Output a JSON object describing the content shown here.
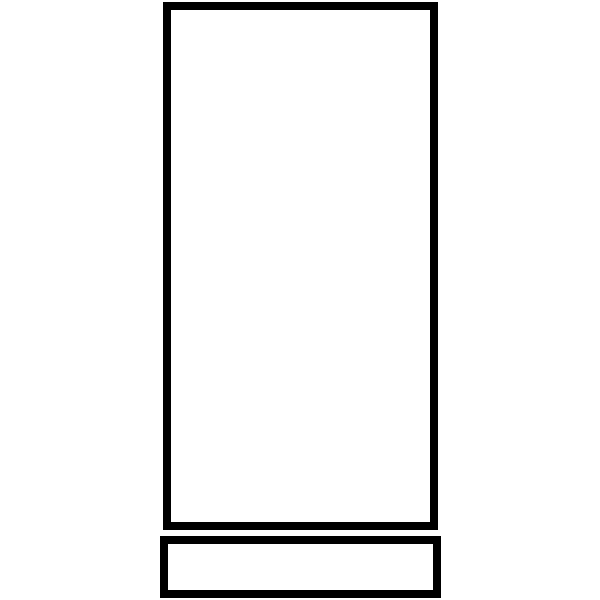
{
  "canvas": {
    "width": 600,
    "height": 600,
    "background_color": "#ffffff"
  },
  "colors": {
    "stroke": "#000000",
    "fill": "#ffffff"
  },
  "shapes": [
    {
      "id": "tall-rectangle-outline",
      "type": "rectangle",
      "x": 163,
      "y": 2,
      "width": 275,
      "height": 528,
      "stroke_color": "#000000",
      "stroke_width": 8,
      "fill_color": "#ffffff"
    },
    {
      "id": "wide-rectangle-outline",
      "type": "rectangle",
      "x": 160,
      "y": 536,
      "width": 281,
      "height": 62,
      "stroke_color": "#000000",
      "stroke_width": 8,
      "fill_color": "#ffffff"
    }
  ]
}
